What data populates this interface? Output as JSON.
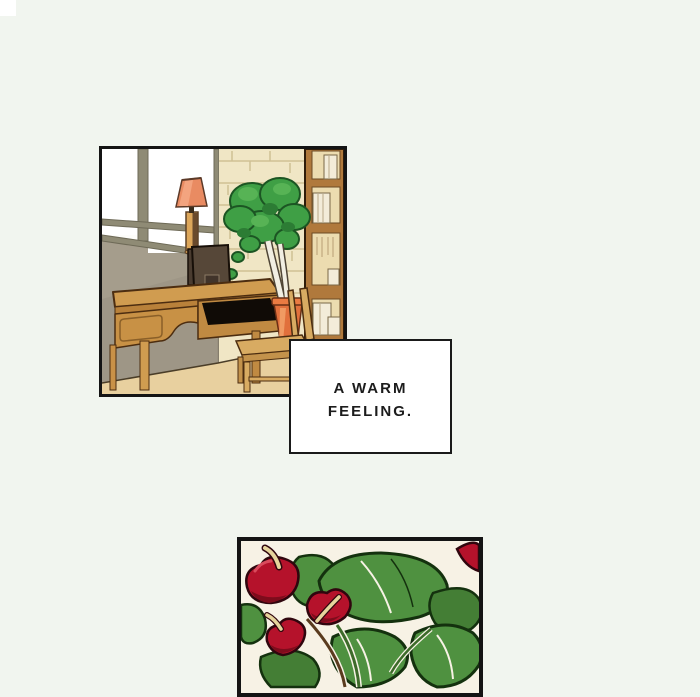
{
  "page": {
    "background_color": "#f1f5ef",
    "corner_square_color": "#ffffff"
  },
  "caption": {
    "line1": "A WARM",
    "line2": "FEELING."
  },
  "panels": {
    "room": {
      "name": "study-room-panel",
      "border_color": "#141414",
      "colors": {
        "wall_gray": "#a59d8c",
        "window_frame_olive": "#8f8b75",
        "brick_wall_cream": "#f0e6c5",
        "brick_line": "#cfc094",
        "bookshelf_wood": "#b0793c",
        "shelf_interior": "#ecdcb0",
        "book_spine": "#f3ecd9",
        "desk_wood": "#d09c50",
        "chair_wood": "#d8ab62",
        "lamp_shade_coral": "#e98b62",
        "lamp_base_tan": "#dca65a",
        "plant_green": "#3f9f45",
        "plant_trunk_white": "#f1eee2",
        "pot_orange": "#e1703c",
        "floor_tan": "#e8d09f",
        "speaker_brown": "#564738"
      }
    },
    "flowers": {
      "name": "anthurium-panel",
      "border_color": "#141414",
      "colors": {
        "background": "#f7f2e5",
        "leaf_green": "#4f9140",
        "leaf_outline": "#14310e",
        "flower_red": "#b5122b",
        "flower_shade": "#7e0c1c",
        "spadix_cream": "#e6d49c"
      }
    }
  }
}
